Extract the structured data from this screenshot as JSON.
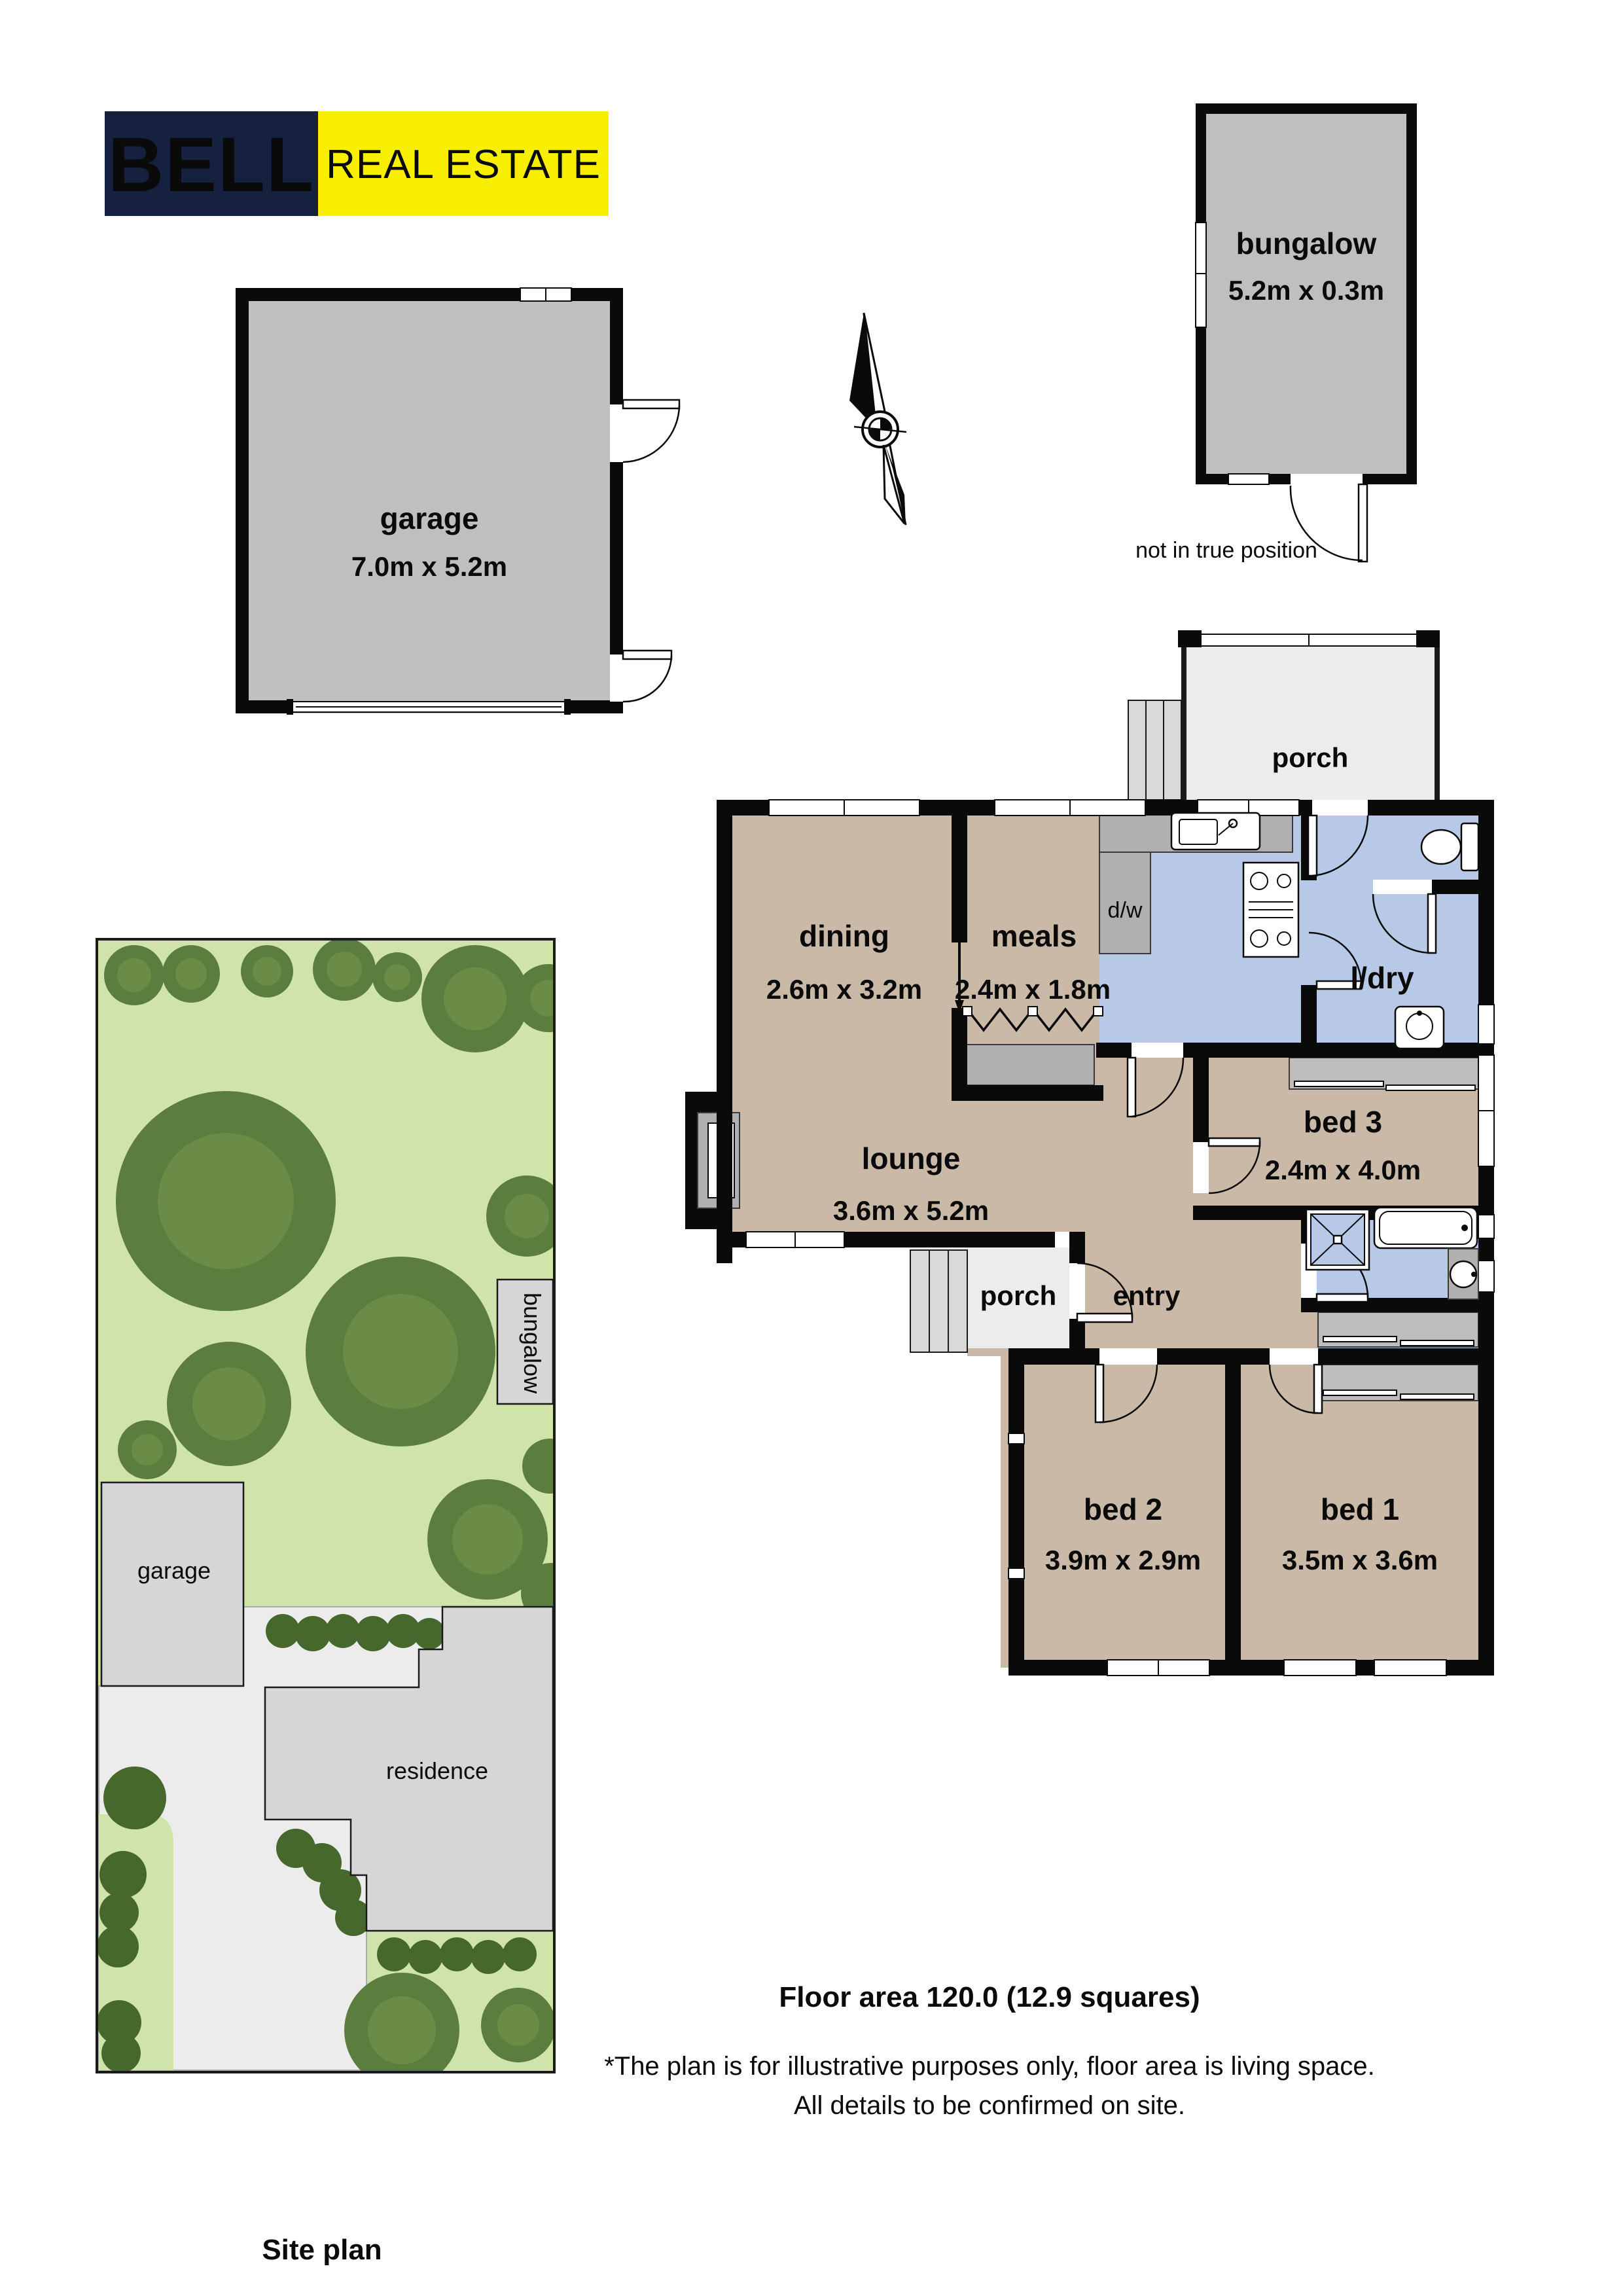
{
  "logo": {
    "brand": "BELL",
    "tagline": "REAL ESTATE",
    "brand_bg": "#15213e",
    "tagline_bg": "#f7ee00",
    "brand_color": "#ffffff",
    "tagline_color": "#15213e"
  },
  "icons": {
    "north_arrow": "compass-needle"
  },
  "rooms": {
    "garage": {
      "label": "garage",
      "dims": "7.0m x 5.2m"
    },
    "bungalow": {
      "label": "bungalow",
      "dims": "5.2m x 0.3m"
    },
    "dining": {
      "label": "dining",
      "dims": "2.6m x 3.2m"
    },
    "meals": {
      "label": "meals",
      "dims": "2.4m x 1.8m"
    },
    "lounge": {
      "label": "lounge",
      "dims": "3.6m x 5.2m"
    },
    "bed3": {
      "label": "bed 3",
      "dims": "2.4m x 4.0m"
    },
    "bed2": {
      "label": "bed 2",
      "dims": "3.9m x 2.9m"
    },
    "bed1": {
      "label": "bed 1",
      "dims": "3.5m x 3.6m"
    },
    "laundry": {
      "label": "l/dry"
    },
    "dishwasher": {
      "label": "d/w"
    },
    "rear_porch": {
      "label": "porch"
    },
    "front_porch": {
      "label": "porch"
    },
    "entry": {
      "label": "entry"
    }
  },
  "annotations": {
    "bungalow_note": "not in true position"
  },
  "site_plan": {
    "title": "Site plan",
    "garage": "garage",
    "bungalow": "bungalow",
    "residence": "residence"
  },
  "footer": {
    "floor_area": "Floor area 120.0 (12.9 squares)",
    "disclaimer_1": "*The plan is for illustrative purposes only, floor area is living space.",
    "disclaimer_2": "All details to be confirmed on site."
  },
  "colors": {
    "wall": "#0a0a0a",
    "floor_tan": "#c9b9a6",
    "wet_area_blue": "#b7c9e6",
    "outbuilding_gray": "#bfbfbf",
    "site_green": "#cfe3ab",
    "tree_green": "#5b7d3d"
  }
}
